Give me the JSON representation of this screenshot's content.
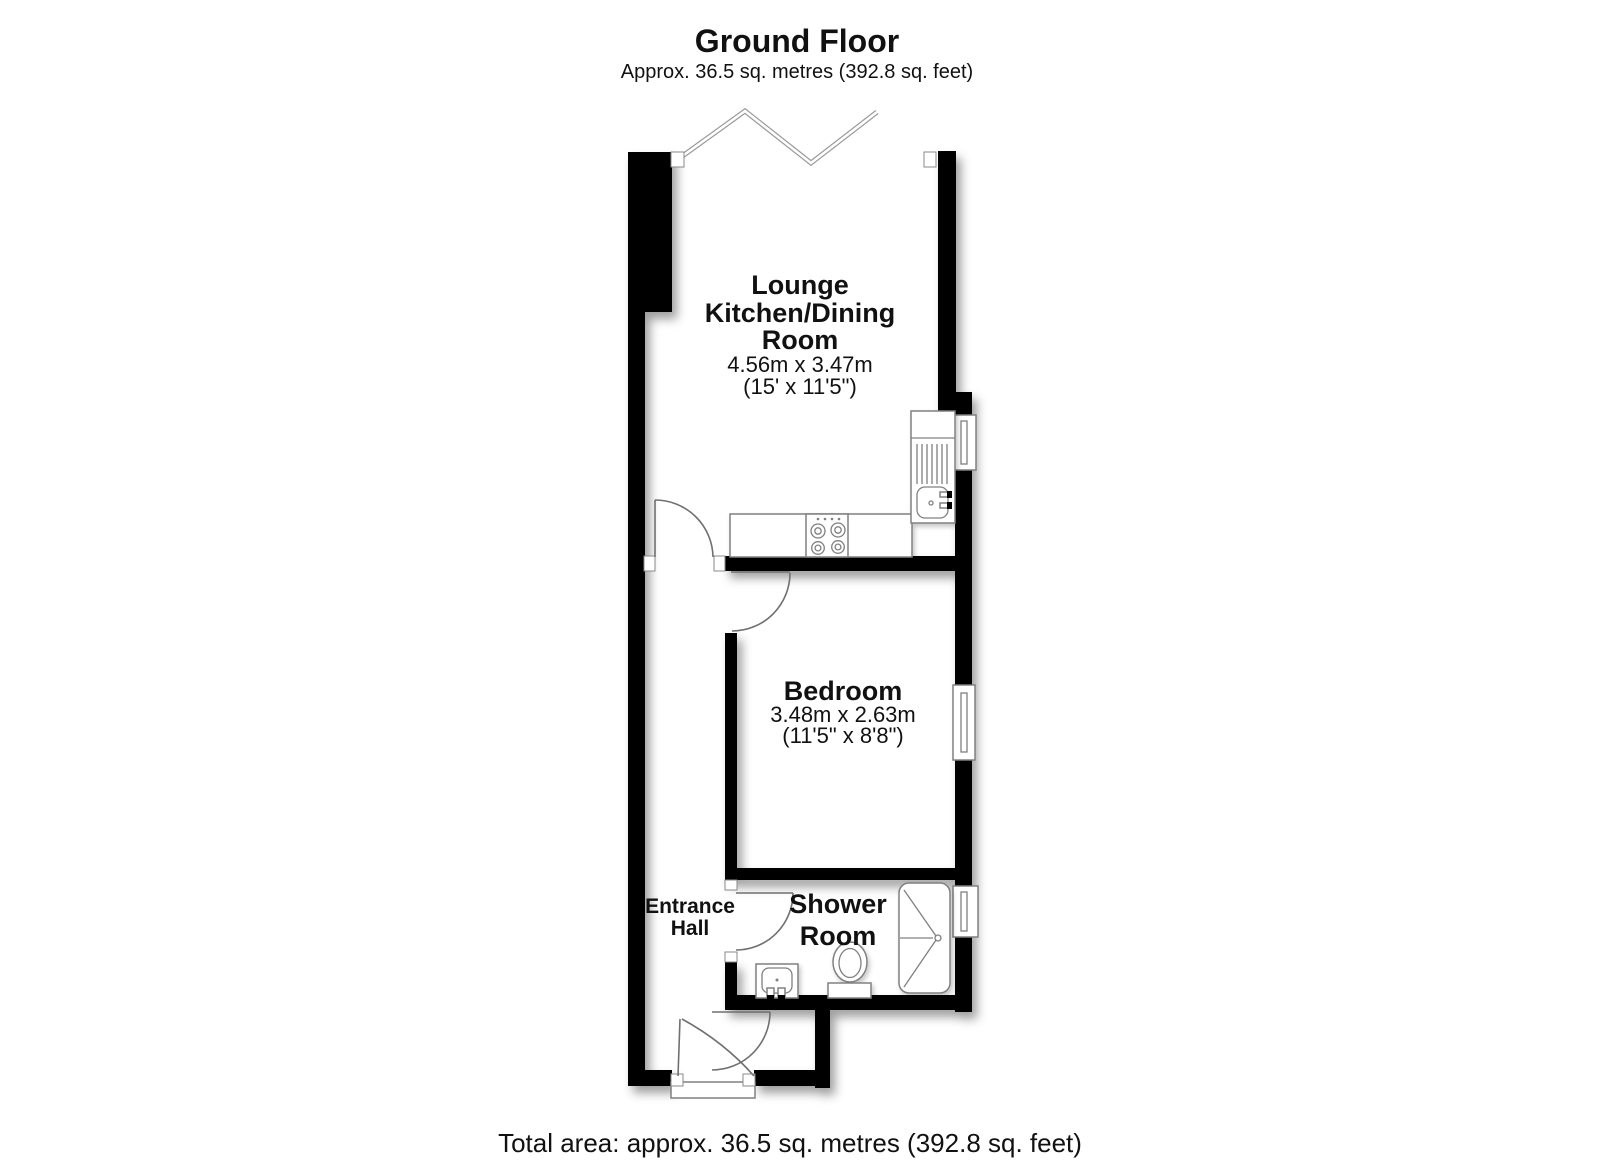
{
  "header": {
    "title": "Ground Floor",
    "subtitle": "Approx. 36.5 sq. metres (392.8 sq. feet)"
  },
  "rooms": {
    "lounge": {
      "name_line1": "Lounge",
      "name_line2": "Kitchen/Dining",
      "name_line3": "Room",
      "dim_metric": "4.56m x 3.47m",
      "dim_imperial": "(15' x 11'5\")"
    },
    "bedroom": {
      "name": "Bedroom",
      "dim_metric": "3.48m x 2.63m",
      "dim_imperial": "(11'5\" x 8'8\")"
    },
    "shower_room": {
      "name_line1": "Shower",
      "name_line2": "Room"
    },
    "entrance_hall": {
      "name_line1": "Entrance",
      "name_line2": "Hall"
    }
  },
  "footer": {
    "total_area": "Total area: approx. 36.5 sq. metres (392.8 sq. feet)"
  },
  "colors": {
    "wall": "#000000",
    "fixture_outline": "#808080",
    "door_arc": "#707070",
    "background": "#ffffff",
    "text": "#111111"
  }
}
